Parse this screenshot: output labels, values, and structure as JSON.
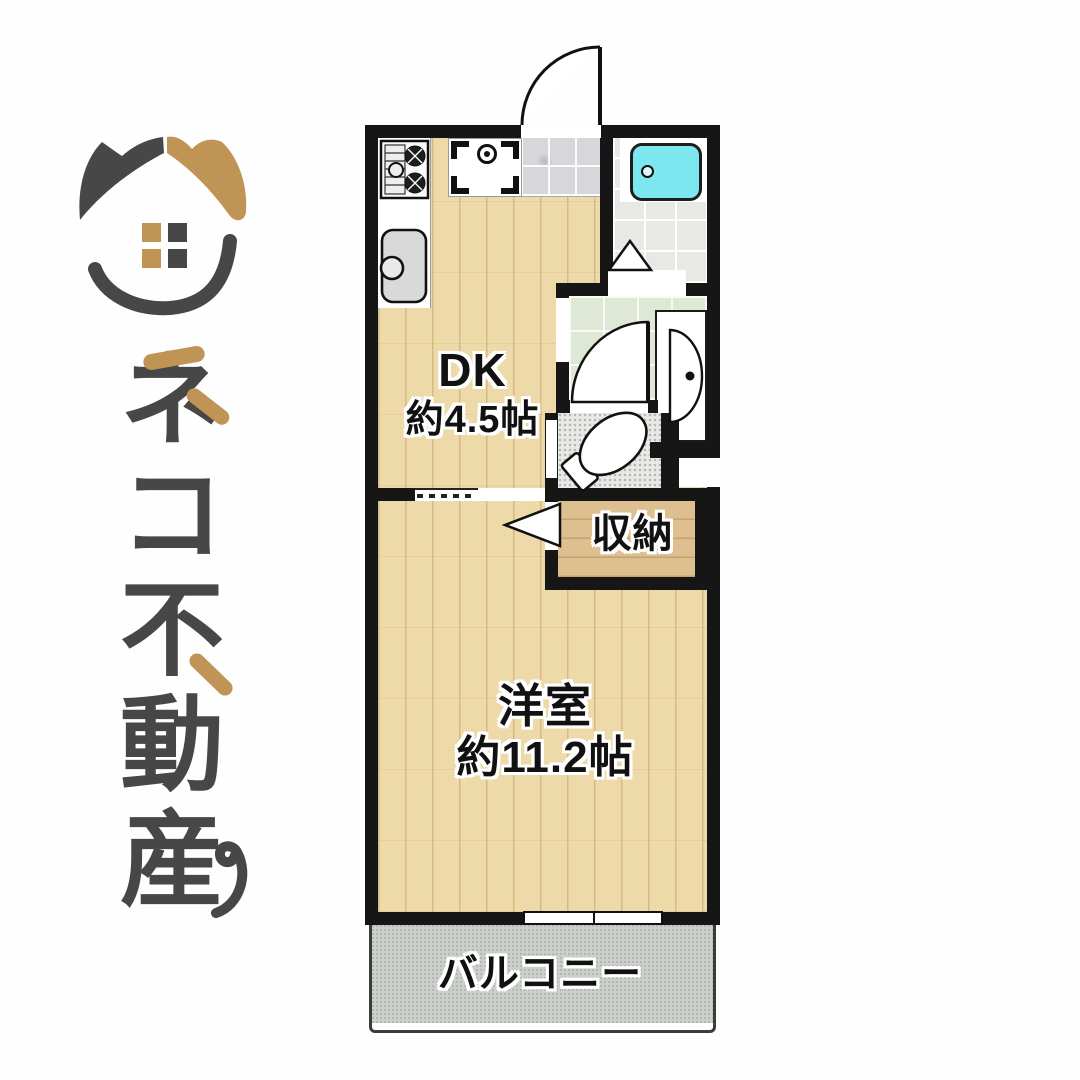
{
  "page": {
    "background": "#ffffff",
    "type": "real-estate floor plan post"
  },
  "logo": {
    "company_name": "ネコ不動産",
    "chars": [
      "ネ",
      "コ",
      "不",
      "動",
      "産"
    ],
    "mark": "calico-cat-ears house with four-pane window and smile",
    "colors": {
      "dark_gray": "#474747",
      "tan": "#bf9455"
    }
  },
  "floorplan": {
    "labels": {
      "dk": {
        "line1": "DK",
        "line2": "約4.5帖"
      },
      "western_room": {
        "line1": "洋室",
        "line2": "約11.2帖"
      },
      "closet": "収納",
      "balcony": "バルコニー"
    },
    "rooms": [
      {
        "name": "DK",
        "size": "約4.5帖",
        "floor": "wood",
        "fixtures": [
          "stove",
          "sink",
          "washer-pan"
        ]
      },
      {
        "name": "洋室",
        "size": "約11.2帖",
        "floor": "wood"
      },
      {
        "name": "収納",
        "floor": "wood"
      },
      {
        "name": "バルコニー",
        "floor": "concrete"
      },
      {
        "name": "bathroom",
        "fixture": "bathtub"
      },
      {
        "name": "washroom",
        "fixture": "washbasin"
      },
      {
        "name": "toilet",
        "fixture": "toilet"
      },
      {
        "name": "entrance",
        "floor": "stone-tile"
      }
    ],
    "colors": {
      "wall": "#161616",
      "wood_floor": "#eedaa9",
      "closet_floor": "#debf8f",
      "bathroom_floor": "#e8e8e4",
      "washroom_floor": "#dfe7d5",
      "toilet_floor": "#e9e9e6",
      "entrance_floor": "#d7d7db",
      "balcony_floor": "#ccd0cb",
      "bathtub": "#7de7f0"
    }
  }
}
